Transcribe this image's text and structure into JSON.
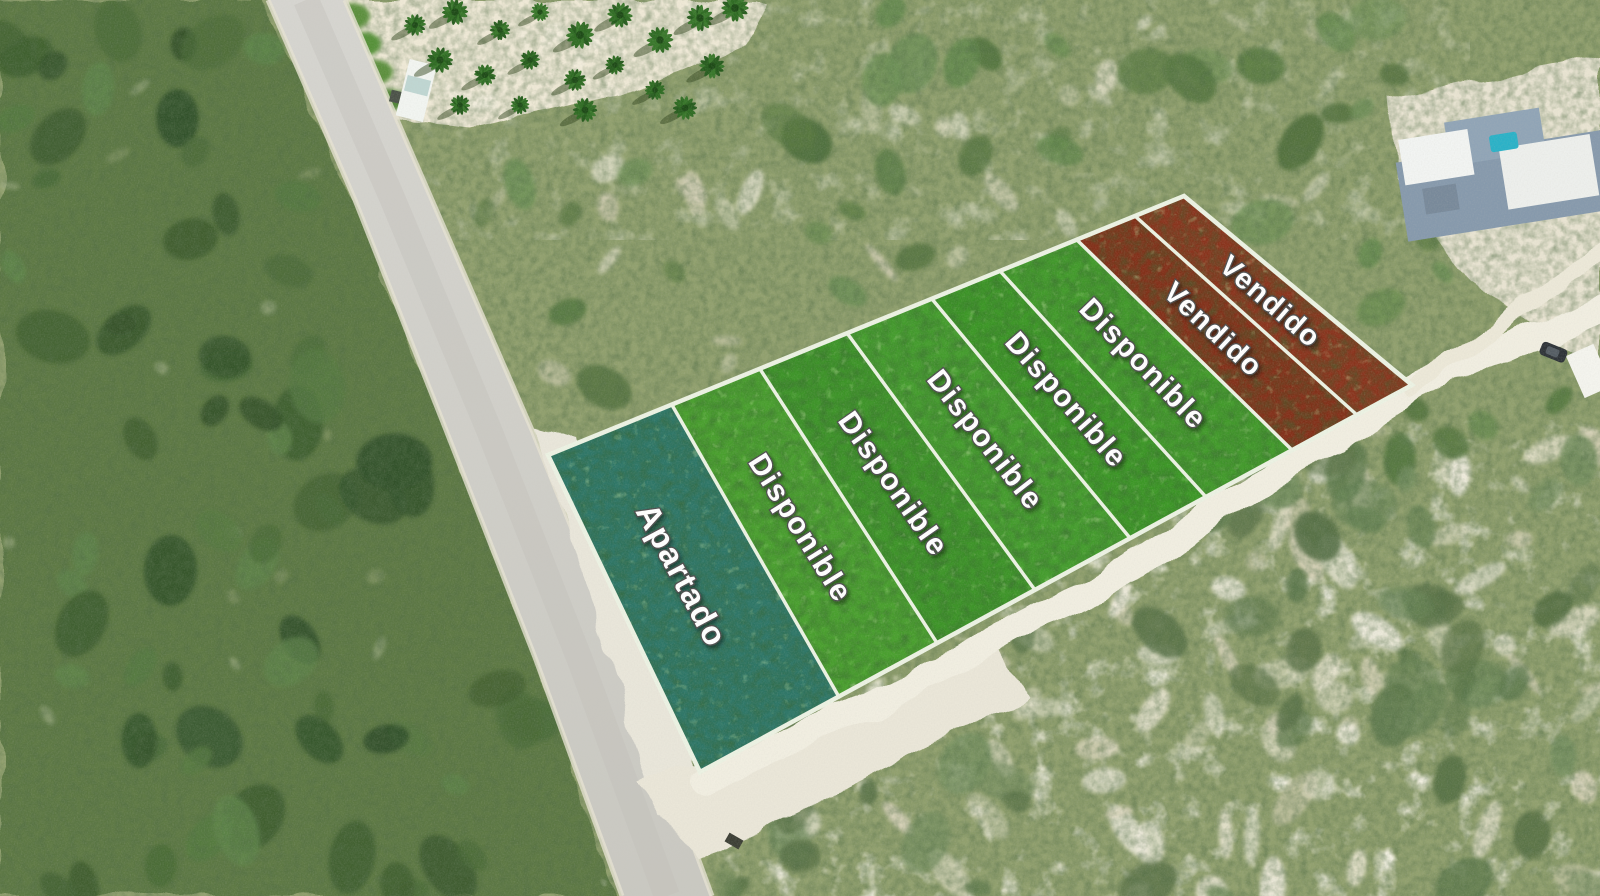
{
  "lots": [
    {
      "id": 1,
      "label": "Apartado",
      "status": "apartado",
      "color": "#2d7c70"
    },
    {
      "id": 2,
      "label": "Disponible",
      "status": "disponible",
      "color": "#4cab2f"
    },
    {
      "id": 3,
      "label": "Disponible",
      "status": "disponible",
      "color": "#3f9e28"
    },
    {
      "id": 4,
      "label": "Disponible",
      "status": "disponible",
      "color": "#47a72d"
    },
    {
      "id": 5,
      "label": "Disponible",
      "status": "disponible",
      "color": "#3da226"
    },
    {
      "id": 6,
      "label": "Disponible",
      "status": "disponible",
      "color": "#44a52b"
    },
    {
      "id": 7,
      "label": "Vendido",
      "status": "vendido",
      "color": "#8c2d17"
    },
    {
      "id": 8,
      "label": "Vendido",
      "status": "vendido",
      "color": "#93321c"
    }
  ],
  "status_legend": {
    "apartado": "#2d7c70",
    "disponible": "#45a52b",
    "vendido": "#8f2f19"
  },
  "counts": {
    "apartado": 1,
    "disponible": 5,
    "vendido": 2
  },
  "overlay": {
    "separator_color": "#ecf2e3",
    "label_text_color": "#ffffff",
    "label_outline_color": "#4e4e4e"
  }
}
